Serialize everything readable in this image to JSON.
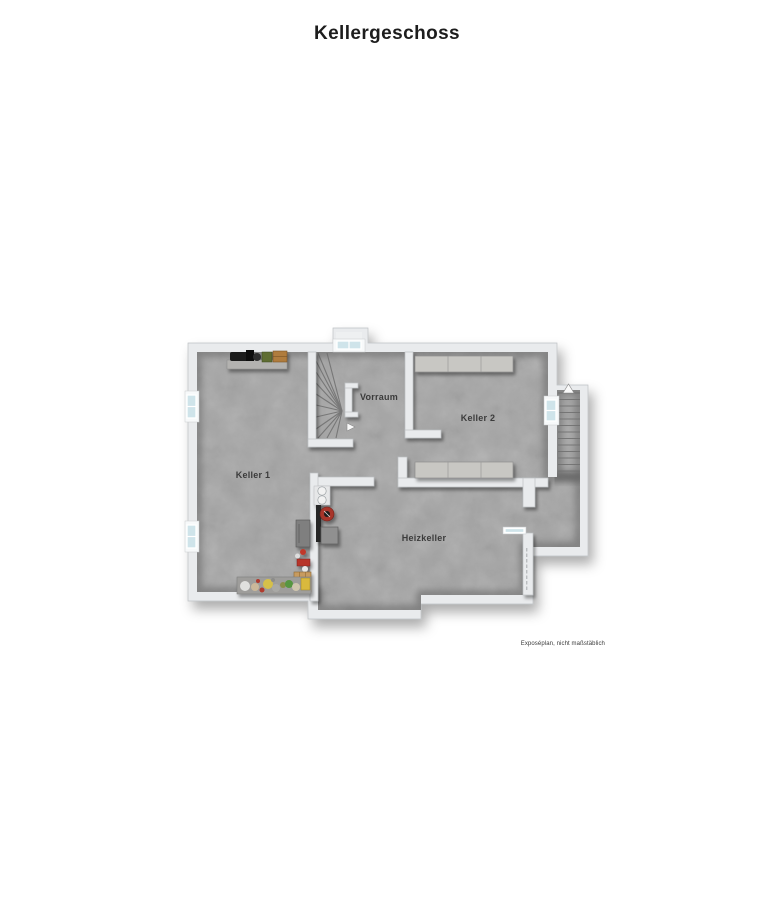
{
  "title": "Kellergeschoss",
  "rooms": {
    "keller1": {
      "label": "Keller 1"
    },
    "vorraum": {
      "label": "Vorraum"
    },
    "keller2": {
      "label": "Keller 2"
    },
    "heizkeller": {
      "label": "Heizkeller"
    }
  },
  "footer": {
    "note": "Exposéplan, nicht maßstäblich"
  },
  "icons": {
    "stair_up_arrow": "triangle-up",
    "stair_entry_arrow": "triangle-right",
    "window": "double-glazed-window",
    "winder_stairs": "winder-staircase",
    "exterior_stairs": "straight-staircase",
    "boiler": "heating-boiler",
    "storage": "storage-shelves"
  },
  "colors": {
    "wall": "#e9ebed",
    "floor": "#a5a5a5",
    "window_glass": "#cfe4ea",
    "shelf": "#c8c7c3",
    "boiler_red": "#a8342c"
  }
}
